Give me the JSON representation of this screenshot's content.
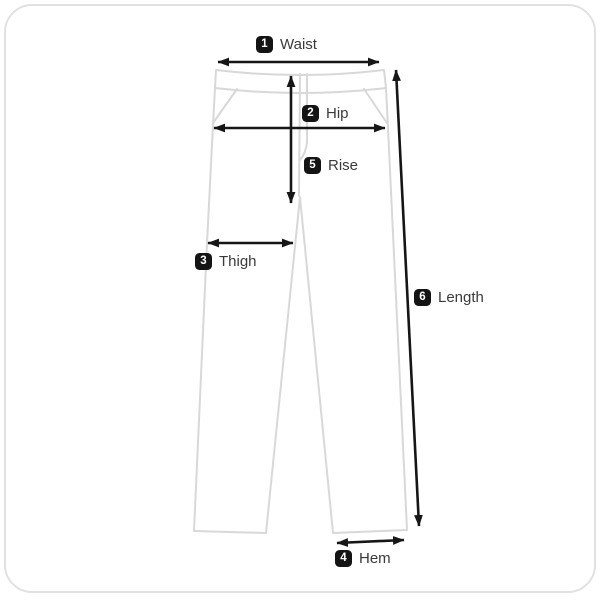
{
  "diagram_type": "garment-measurement-guide",
  "garment": "pants",
  "measurements": {
    "waist": {
      "number": "1",
      "label": "Waist"
    },
    "hip": {
      "number": "2",
      "label": "Hip"
    },
    "thigh": {
      "number": "3",
      "label": "Thigh"
    },
    "hem": {
      "number": "4",
      "label": "Hem"
    },
    "rise": {
      "number": "5",
      "label": "Rise"
    },
    "length": {
      "number": "6",
      "label": "Length"
    }
  },
  "colors": {
    "background": "#ffffff",
    "border": "#e1e1e1",
    "garment_outline": "#d8d8d8",
    "arrow": "#161616",
    "badge_bg": "#141414",
    "badge_text": "#ffffff",
    "label_text": "#3a3a3a"
  }
}
